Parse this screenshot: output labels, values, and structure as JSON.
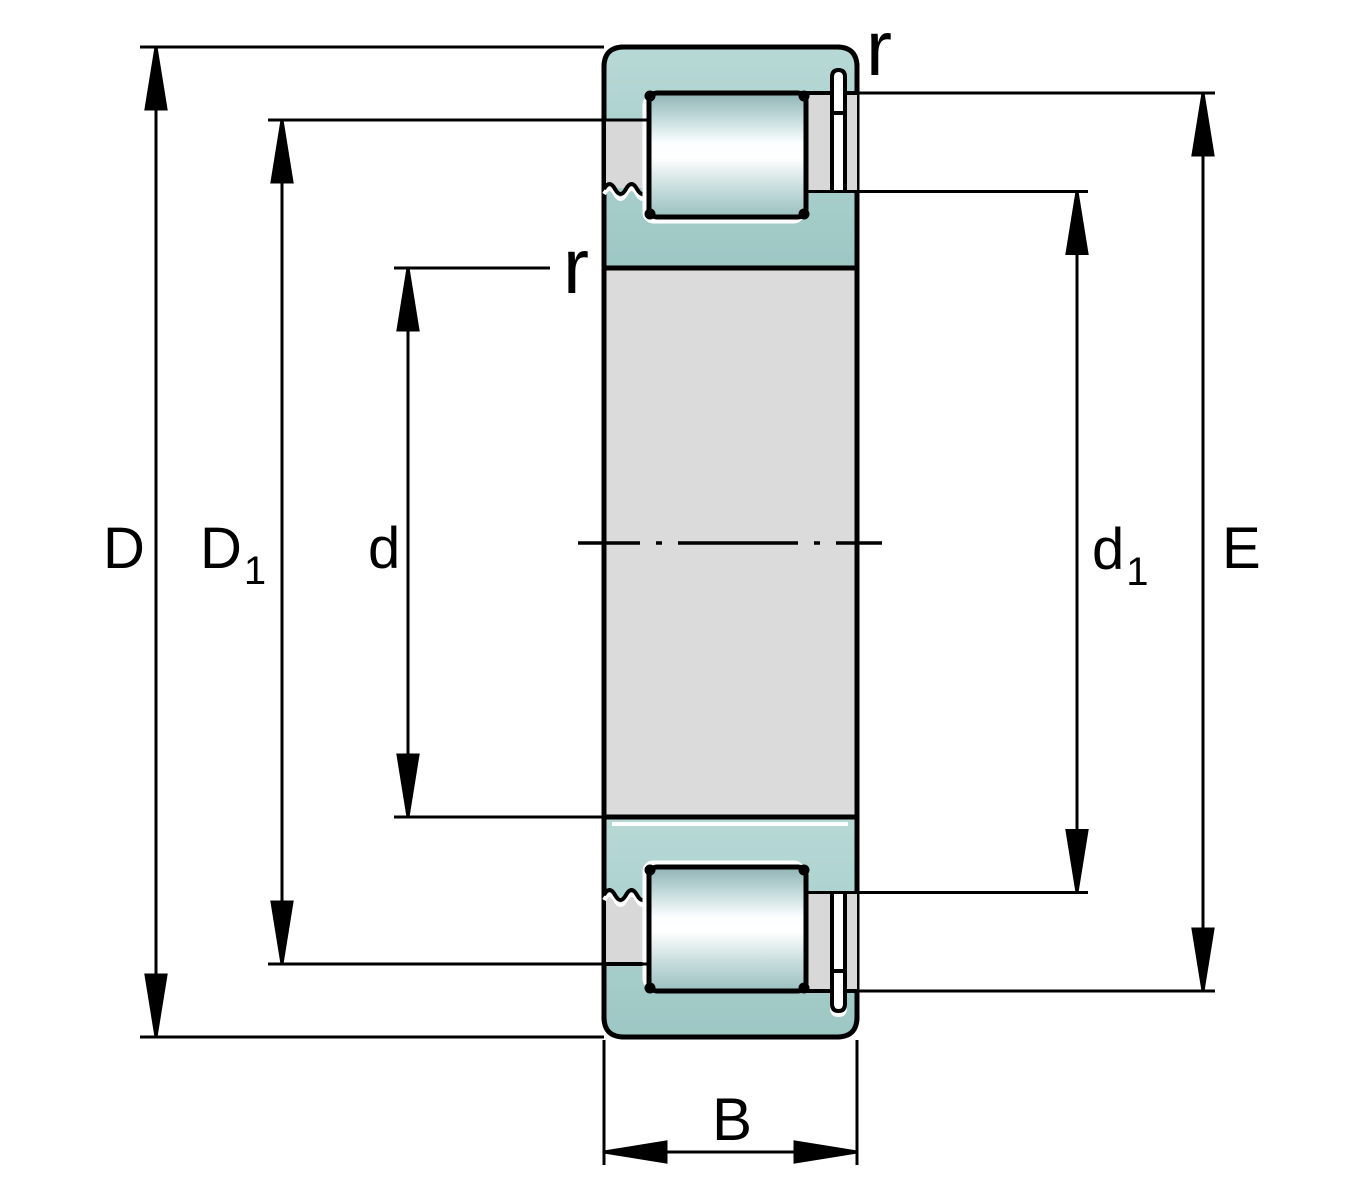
{
  "title": "Cylindrical roller bearing cross-section dimension drawing",
  "labels": {
    "D": "D",
    "D1_main": "D",
    "D1_sub": "1",
    "d": "d",
    "d1_main": "d",
    "d1_sub": "1",
    "E": "E",
    "B": "B",
    "r_outer": "r",
    "r_inner": "r"
  },
  "colors": {
    "outline": "#000000",
    "background": "#ffffff",
    "body_gray": "#dbdbdb",
    "patch_gray": "#d8d8d8",
    "teal_top": "#b7d9d6",
    "teal_bottom": "#9dc7c4",
    "roller": {
      "s0": "#8fb3b4",
      "s1": "#bcd6d6",
      "s2": "#fbfeff",
      "s3": "#ffffff",
      "s4": "#c8dedd",
      "s5": "#9ac0c0"
    },
    "halo_white": "#ffffff"
  }
}
